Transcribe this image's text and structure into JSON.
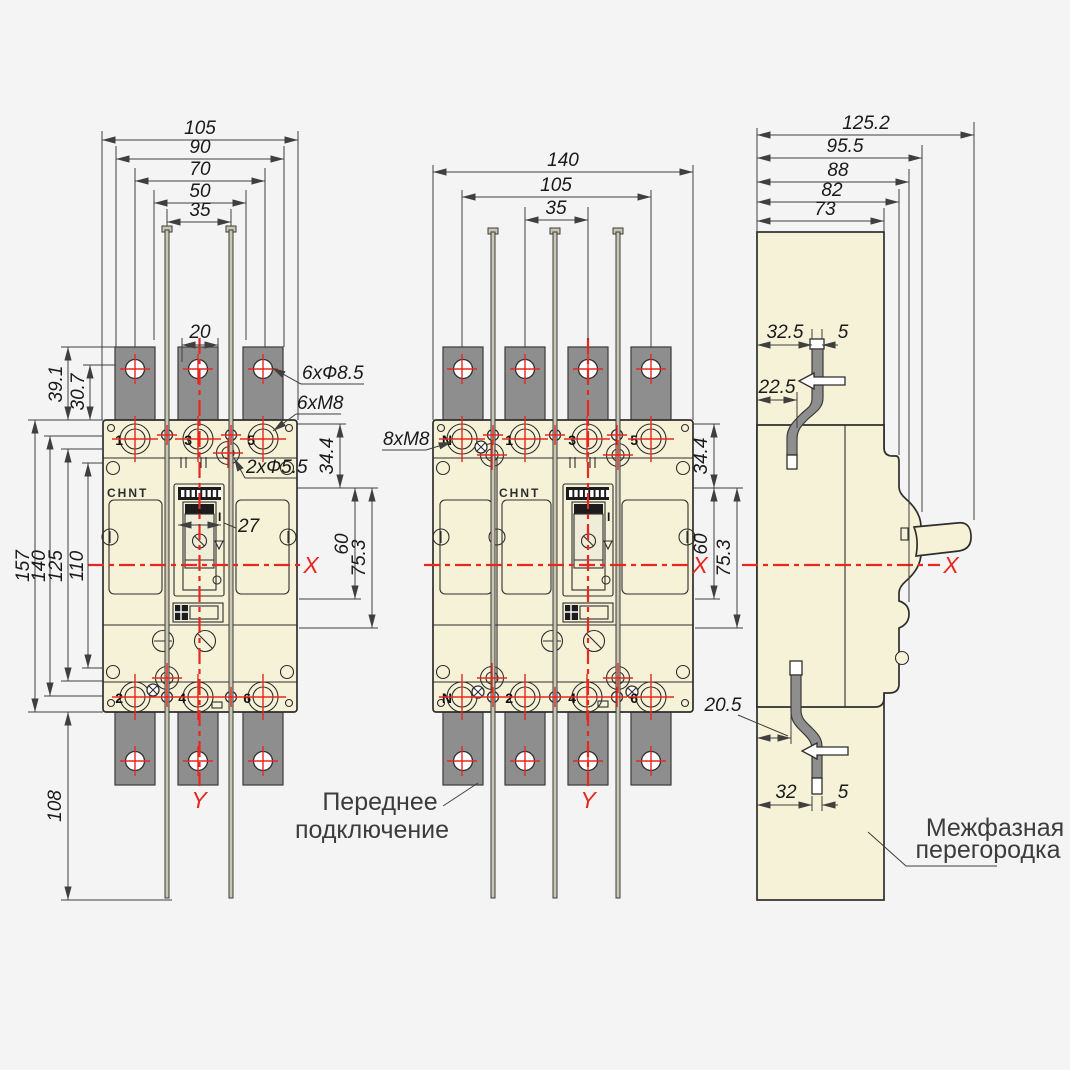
{
  "colors": {
    "body": "#f6f2d7",
    "strap": "#8e8e8e",
    "red": "#e8271f",
    "line": "#2e2e2e",
    "background": "#f4f4f5"
  },
  "brand": "CHNT",
  "left_view": {
    "dims_top": [
      "105",
      "90",
      "70",
      "50",
      "35"
    ],
    "dim_slot": "20",
    "dims_left_upper": [
      "39.1",
      "30.7"
    ],
    "dims_left": [
      "157",
      "140",
      "125",
      "110"
    ],
    "dim_bottom": "108",
    "dims_right": [
      "34.4",
      "60",
      "75.3"
    ],
    "dim_handle": "27",
    "callout_holes": "6xФ8.5",
    "callout_thread": "6xM8",
    "callout_small_holes": "2xФ5.5",
    "terminals_top": [
      "1",
      "3",
      "5"
    ],
    "terminals_bottom": [
      "2",
      "4",
      "6"
    ],
    "handle_mark": "I"
  },
  "middle_view": {
    "dims_top": [
      "140",
      "105",
      "35"
    ],
    "dims_right": [
      "34.4",
      "60",
      "75.3"
    ],
    "callout_thread": "8xM8",
    "terminals_top": [
      "N",
      "1",
      "3",
      "5"
    ],
    "terminals_bottom": [
      "N",
      "2",
      "4",
      "6"
    ],
    "handle_mark": "I"
  },
  "side_view": {
    "dims_top": [
      "125.2",
      "95.5",
      "88",
      "82",
      "73"
    ],
    "dims_upper": [
      "32.5",
      "5",
      "22.5"
    ],
    "dims_lower": [
      "20.5",
      "32",
      "5"
    ]
  },
  "axes": {
    "x": "X",
    "y": "Y"
  },
  "annotations": {
    "front_connection_line1": "Переднее",
    "front_connection_line2": "подключение",
    "barrier_line1": "Межфазная",
    "barrier_line2": "перегородка"
  }
}
